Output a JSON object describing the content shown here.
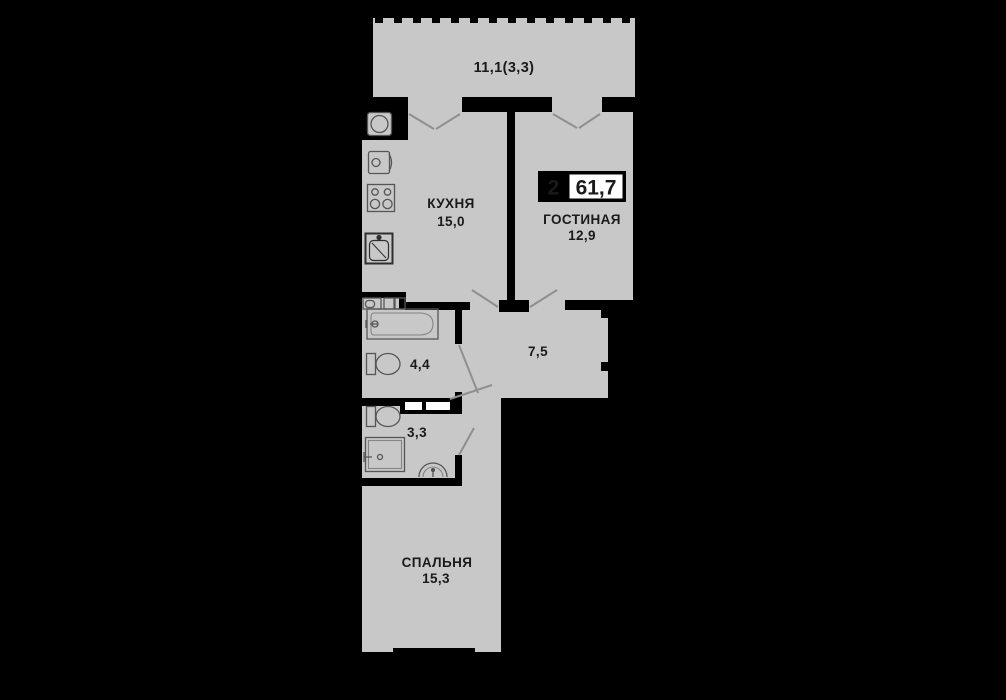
{
  "badge": {
    "room_count": "2",
    "total_area": "61,7"
  },
  "balcony": {
    "area": "11,1(3,3)"
  },
  "kitchen": {
    "name": "КУХНЯ",
    "area": "15,0"
  },
  "living_room": {
    "name": "ГОСТИНАЯ",
    "area": "12,9"
  },
  "hallway": {
    "area": "7,5"
  },
  "bathroom": {
    "area": "4,4"
  },
  "wc": {
    "area": "3,3"
  },
  "bedroom": {
    "name": "СПАЛЬНЯ",
    "area": "15,3"
  },
  "colors": {
    "background": "#000000",
    "floor": "#c8c8c8",
    "wall": "#000000",
    "text": "#1a1a1a",
    "badge_background": "#000000",
    "badge_value_box": "#ffffff"
  }
}
